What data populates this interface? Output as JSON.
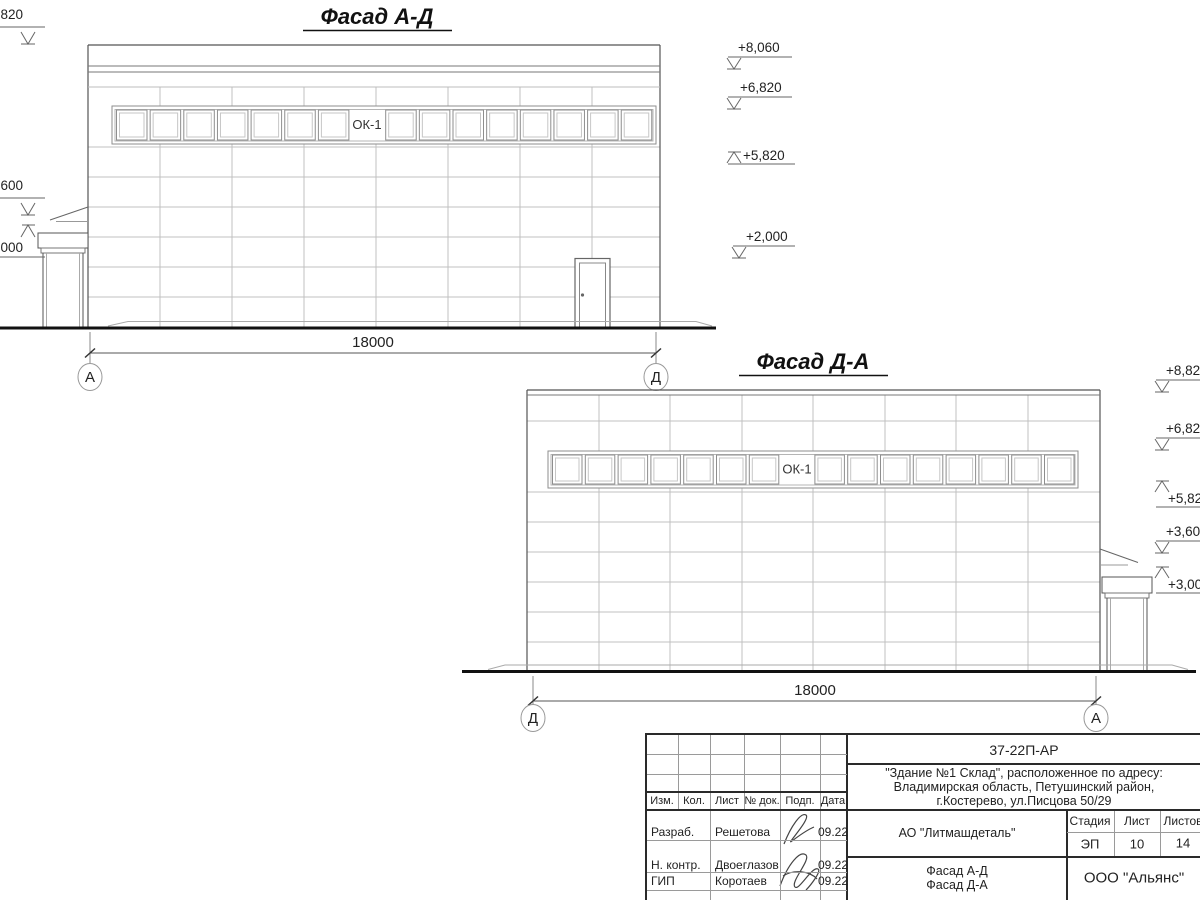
{
  "facade1": {
    "title": "Фасад А-Д",
    "window_label": "ОК-1",
    "window_panes": 16,
    "dimension": "18000",
    "axis_left": "А",
    "axis_right": "Д",
    "left_marks": [
      "820",
      "600",
      "000"
    ],
    "right_marks": [
      "+8,060",
      "+6,820",
      "+5,820",
      "+2,000"
    ]
  },
  "facade2": {
    "title": "Фасад Д-А",
    "window_label": "ОК-1",
    "window_panes": 16,
    "dimension": "18000",
    "axis_left": "Д",
    "axis_right": "А",
    "right_marks": [
      "+8,82",
      "+6,82",
      "+5,82",
      "+3,60",
      "+3,00"
    ]
  },
  "title_block": {
    "doc_number": "37-22П-АР",
    "object_line1": "\"Здание №1 Склад\", расположенное по адресу:",
    "object_line2": "Владимирская область, Петушинский район,",
    "object_line3": "г.Костерево, ул.Писцова 50/29",
    "client": "АО \"Литмашдеталь\"",
    "sheet_title_line1": "Фасад А-Д",
    "sheet_title_line2": "Фасад Д-А",
    "organization": "ООО \"Альянс\"",
    "stage_header": "Стадия",
    "sheet_header": "Лист",
    "sheets_header": "Листов",
    "stage": "ЭП",
    "sheet": "10",
    "sheets": "14",
    "columns": [
      "Изм.",
      "Кол.",
      "Лист",
      "№ док.",
      "Подп.",
      "Дата"
    ],
    "rows": [
      {
        "role": "Разраб.",
        "name": "Решетова",
        "date": "09.22"
      },
      {
        "role": "Н. контр.",
        "name": "Двоеглазов",
        "date": "09.22"
      },
      {
        "role": "ГИП",
        "name": "Коротаев",
        "date": "09.22"
      }
    ]
  }
}
